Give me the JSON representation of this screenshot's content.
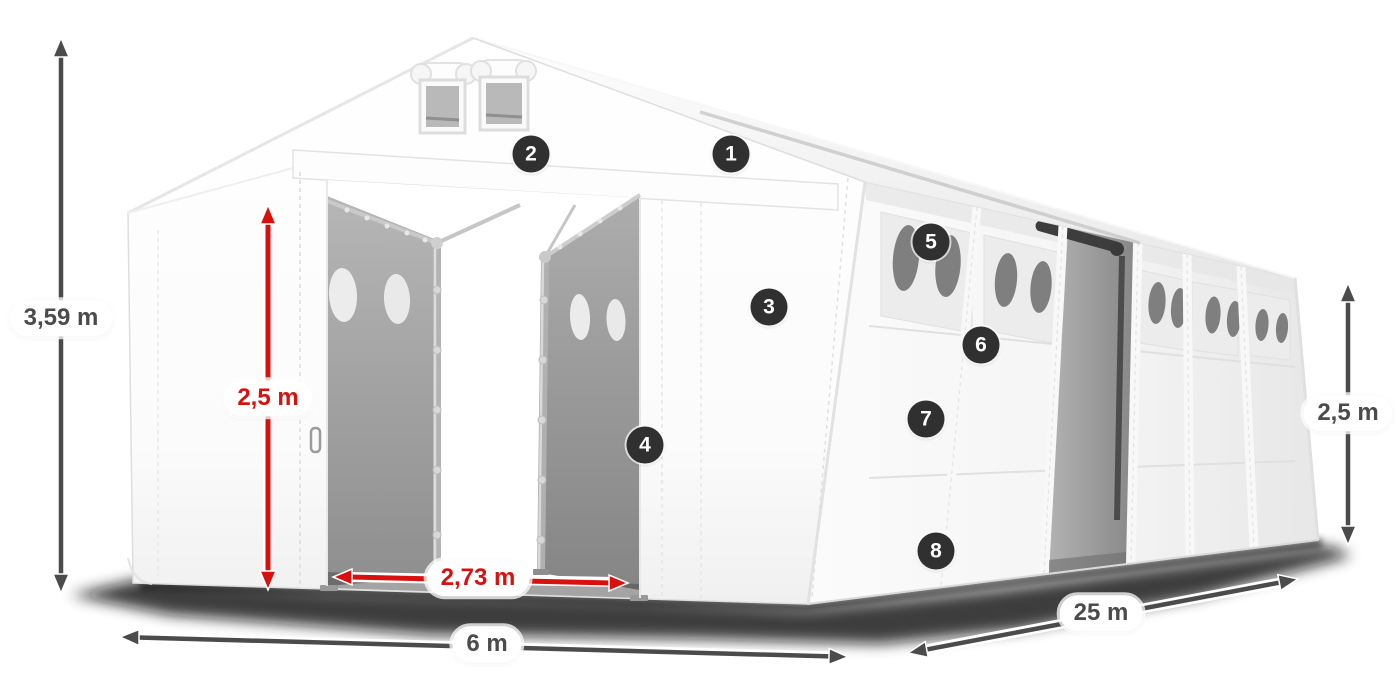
{
  "markers": [
    "1",
    "2",
    "3",
    "4",
    "5",
    "6",
    "7",
    "8"
  ],
  "dimensions": {
    "total_height": "3,59 m",
    "door_height": "2,5 m",
    "door_width": "2,73 m",
    "front_width": "6 m",
    "length": "25 m",
    "side_height": "2,5 m"
  },
  "colors": {
    "accent_red": "#d8100e",
    "dimension_gray": "#4b4b4b",
    "badge_bg": "#303030"
  }
}
